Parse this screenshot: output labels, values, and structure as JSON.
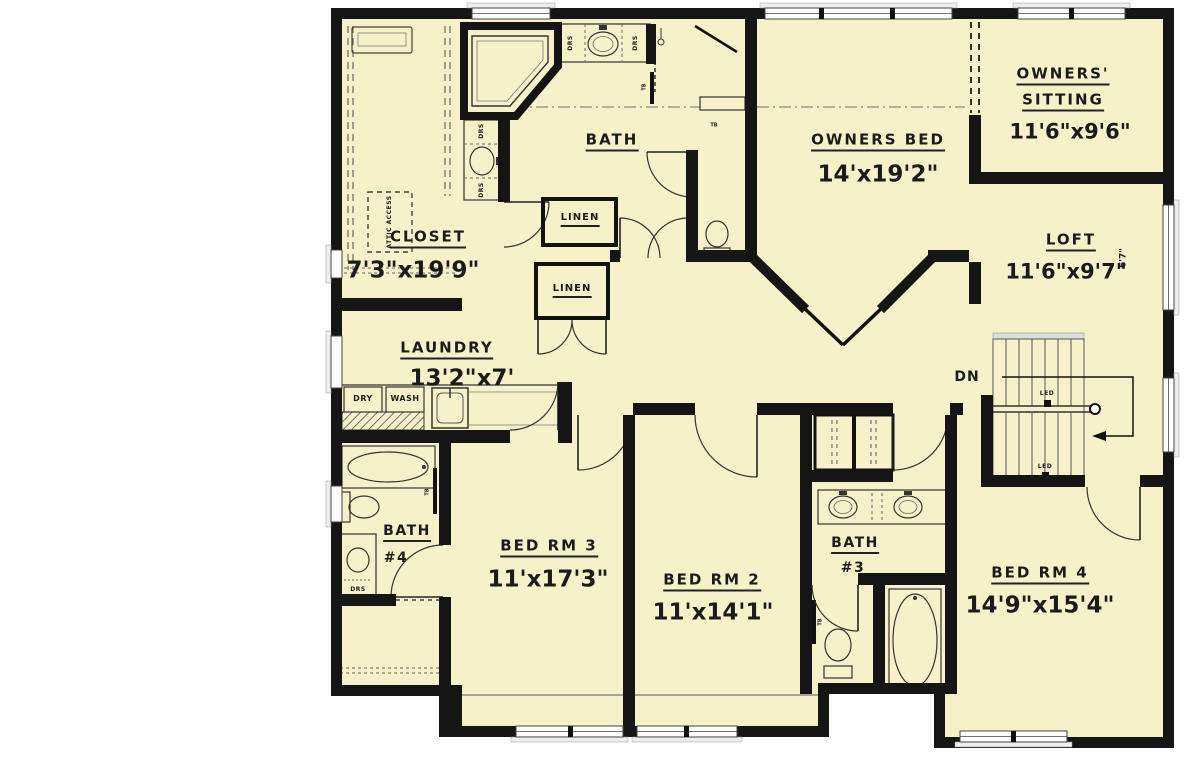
{
  "plan": {
    "type": "second-floor-plan",
    "colors": {
      "floor": "#f7f1ca",
      "wall": "#151515",
      "window_sill": "#e9e9e9",
      "line": "#555555"
    },
    "rooms": {
      "bath_owner": {
        "name": "BATH"
      },
      "owners_bed": {
        "name": "OWNERS BED",
        "dims": "14'x19'2\""
      },
      "owners_sitting": {
        "line1": "OWNERS'",
        "line2": "SITTING",
        "dims": "11'6\"x9'6\""
      },
      "loft": {
        "name": "LOFT",
        "dims": "11'6\"x9'7\"",
        "note": "6'7\""
      },
      "closet": {
        "name": "CLOSET",
        "dims": "7'3\"x19'9\""
      },
      "laundry": {
        "name": "LAUNDRY",
        "dims": "13'2\"x7'"
      },
      "bath4": {
        "name": "BATH",
        "number": "#4"
      },
      "bed3": {
        "name": "BED RM 3",
        "dims": "11'x17'3\""
      },
      "bed2": {
        "name": "BED RM 2",
        "dims": "11'x14'1\""
      },
      "bath3": {
        "name": "BATH",
        "number": "#3"
      },
      "bed4": {
        "name": "BED RM 4",
        "dims": "14'9\"x15'4\""
      }
    },
    "fixtures": {
      "linen": "LINEN",
      "dry": "DRY",
      "wash": "WASH",
      "down": "DN",
      "ledge": "LED",
      "towel_bar": "TB",
      "drawers": "DRS",
      "attic": "ATTIC ACCESS"
    }
  }
}
